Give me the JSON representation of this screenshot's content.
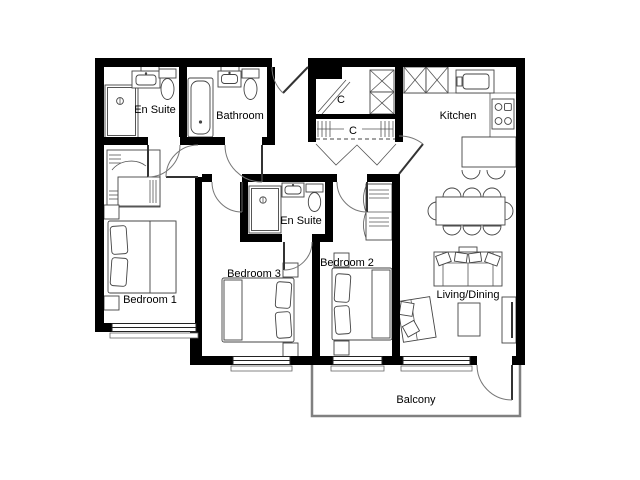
{
  "floor_plan": {
    "rooms": {
      "en_suite_top": {
        "label": "En Suite"
      },
      "bathroom": {
        "label": "Bathroom"
      },
      "closet_top": {
        "label": "C"
      },
      "closet_hall": {
        "label": "C"
      },
      "kitchen": {
        "label": "Kitchen"
      },
      "en_suite_middle": {
        "label": "En Suite"
      },
      "bedroom_1": {
        "label": "Bedroom 1"
      },
      "bedroom_2": {
        "label": "Bedroom 2"
      },
      "bedroom_3": {
        "label": "Bedroom 3"
      },
      "living_dining": {
        "label": "Living/Dining"
      },
      "balcony": {
        "label": "Balcony"
      }
    },
    "colors": {
      "wall": "#000000",
      "furniture_line": "#444444",
      "balcony_outline": "#808080",
      "background": "#ffffff",
      "label_text": "#000000"
    }
  }
}
